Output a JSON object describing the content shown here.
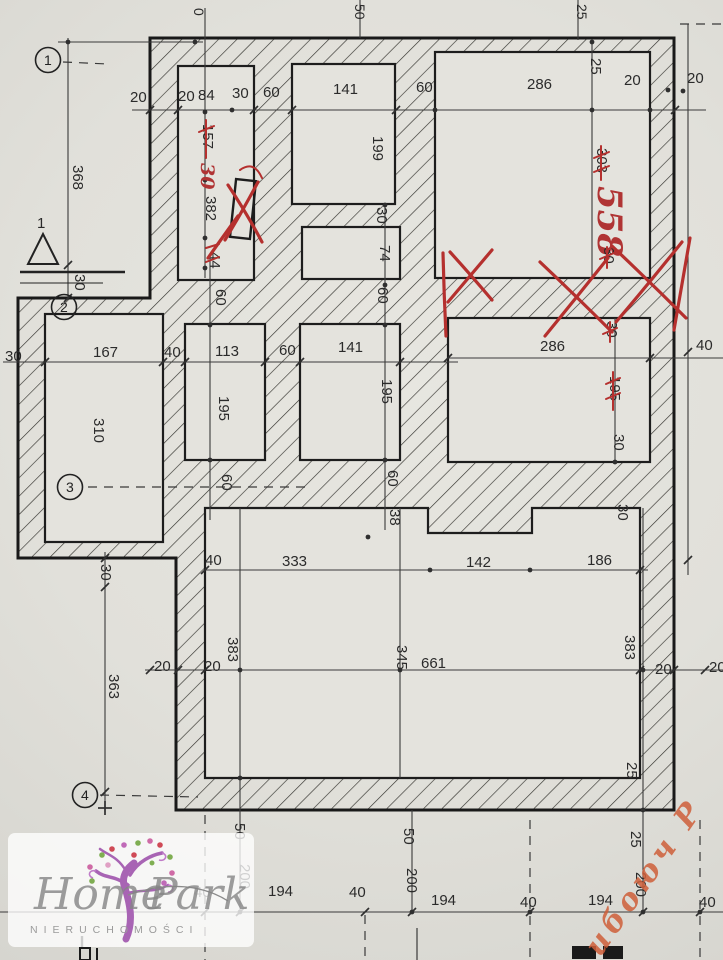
{
  "drawing_type": "floor-plan",
  "axis": [
    "1",
    "2",
    "3",
    "4"
  ],
  "tri": "1",
  "top_edge": [
    "0",
    "50",
    "25"
  ],
  "top": [
    "20",
    "20",
    "84",
    "30",
    "60",
    "141",
    "60",
    "286",
    "25",
    "20",
    "20"
  ],
  "left": [
    "368",
    "30",
    "30",
    "30",
    "363"
  ],
  "col1": [
    "157",
    "30",
    "382",
    "44"
  ],
  "mid": [
    "167",
    "40",
    "113",
    "60",
    "141",
    "286",
    "40"
  ],
  "vmid": [
    "310",
    "195",
    "195",
    "199",
    "30",
    "74",
    "60",
    "60",
    "60",
    "60"
  ],
  "rcol": [
    "303",
    "558",
    "30",
    "30",
    "195",
    "30",
    "30"
  ],
  "big": [
    "40",
    "333",
    "142",
    "186",
    "38",
    "20",
    "20",
    "383",
    "345",
    "661",
    "383",
    "20",
    "20",
    "25"
  ],
  "bottom": [
    "50",
    "50",
    "25",
    "200",
    "200",
    "200",
    "40",
    "194",
    "40",
    "194",
    "40",
    "194",
    "40"
  ],
  "logo": {
    "home": "Home",
    "park": "Park",
    "sub": "NIERUCHOMOŚCI"
  },
  "stamp": "ибоюч Р",
  "colors": {
    "annotation_red": "#b5302e",
    "stamp_orange": "#cf5f3a",
    "logo_purple": "#a864b4"
  }
}
